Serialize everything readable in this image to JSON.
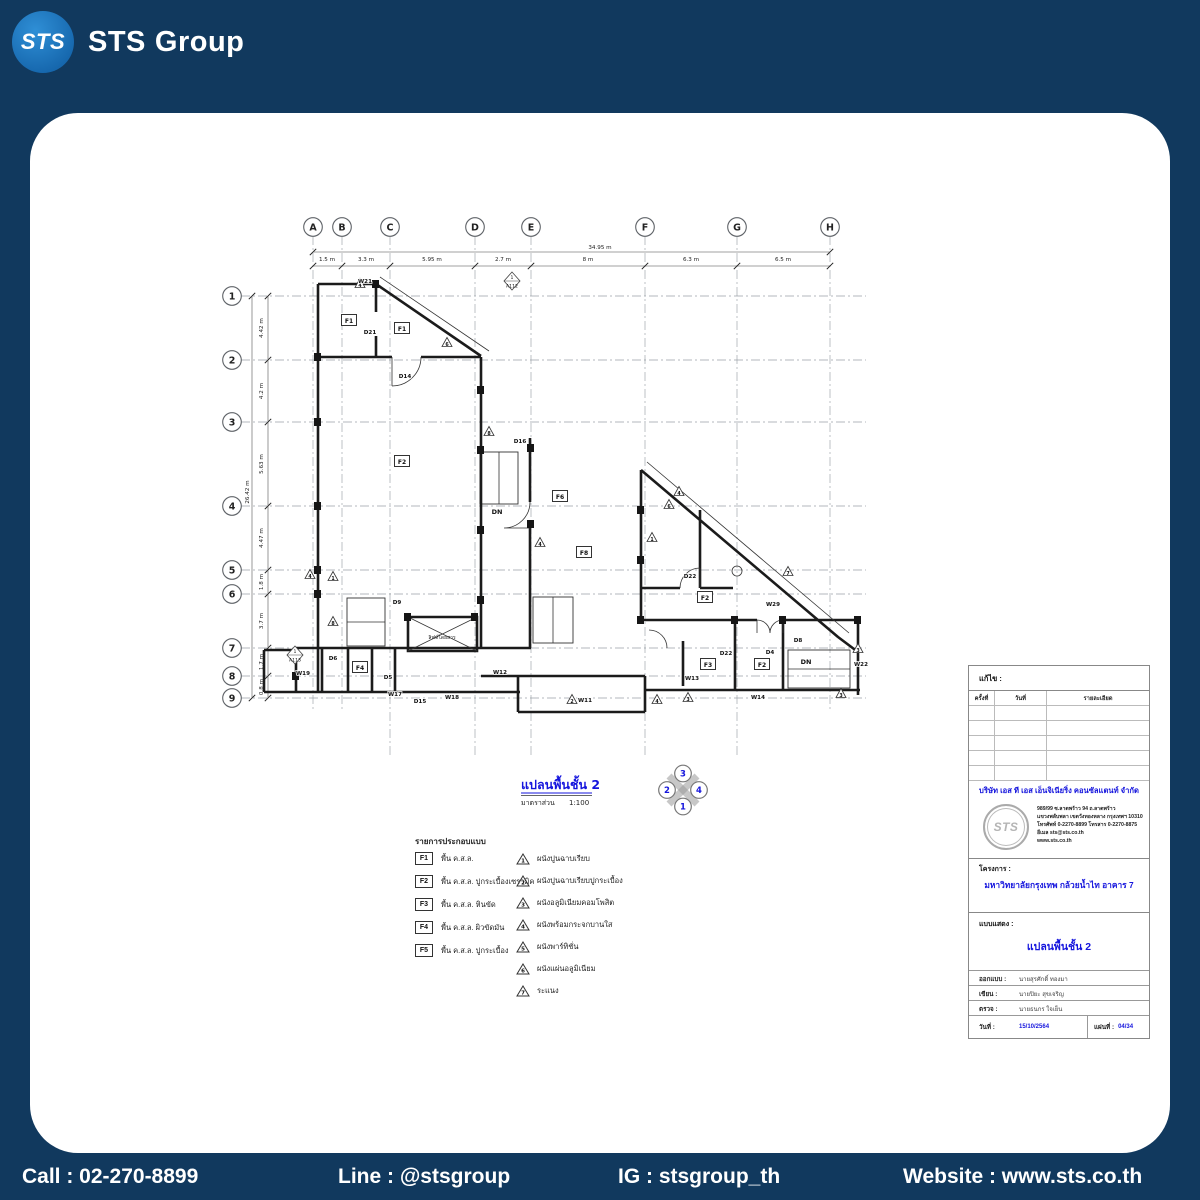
{
  "brand": {
    "circle_text": "STS",
    "word1": "STS",
    "word2": "Group"
  },
  "footer": {
    "items": [
      "Call : 02-270-8899",
      "Line : @stsgroup",
      "IG : stsgroup_th",
      "Website : www.sts.co.th"
    ]
  },
  "colors": {
    "background": "#11395e",
    "card": "#ffffff",
    "accent_blue": "#1515dd",
    "logo_blue": "#1e78c8"
  },
  "plan": {
    "title": "แปลนพื้นชั้น 2",
    "scale_label": "มาตราส่วน",
    "scale_value": "1:100",
    "north": {
      "top": "3",
      "left": "2",
      "right": "4",
      "bottom": "1"
    },
    "grid_columns": [
      {
        "label": "A",
        "x": 313
      },
      {
        "label": "B",
        "x": 342
      },
      {
        "label": "C",
        "x": 390
      },
      {
        "label": "D",
        "x": 475
      },
      {
        "label": "E",
        "x": 531
      },
      {
        "label": "F",
        "x": 645
      },
      {
        "label": "G",
        "x": 737
      },
      {
        "label": "H",
        "x": 830
      }
    ],
    "grid_rows": [
      {
        "label": "1",
        "y": 296
      },
      {
        "label": "2",
        "y": 360
      },
      {
        "label": "3",
        "y": 422
      },
      {
        "label": "4",
        "y": 506
      },
      {
        "label": "5",
        "y": 570
      },
      {
        "label": "6",
        "y": 594
      },
      {
        "label": "7",
        "y": 648
      },
      {
        "label": "8",
        "y": 676
      },
      {
        "label": "9",
        "y": 698
      }
    ],
    "dim_top": {
      "total": "34.95 m",
      "segments": [
        {
          "label": "1.5 m",
          "x": 327
        },
        {
          "label": "3.3 m",
          "x": 366
        },
        {
          "label": "5.95 m",
          "x": 432
        },
        {
          "label": "2.7 m",
          "x": 503
        },
        {
          "label": "8 m",
          "x": 588
        },
        {
          "label": "6.3 m",
          "x": 691
        },
        {
          "label": "6.5 m",
          "x": 783
        }
      ]
    },
    "dim_left": {
      "total": "26.42 m",
      "segments": [
        {
          "label": "4.42 m",
          "y": 328
        },
        {
          "label": "4.2 m",
          "y": 391
        },
        {
          "label": "5.63 m",
          "y": 464
        },
        {
          "label": "4.47 m",
          "y": 538
        },
        {
          "label": "1.8 m",
          "y": 582
        },
        {
          "label": "3.7 m",
          "y": 621
        },
        {
          "label": "1.7 m",
          "y": 662
        },
        {
          "label": "0.8 m",
          "y": 687
        }
      ]
    },
    "diamonds": [
      {
        "top": "1",
        "bottom": "A112",
        "x": 512,
        "y": 281
      },
      {
        "top": "1",
        "bottom": "A113",
        "x": 295,
        "y": 655
      }
    ],
    "triangles": [
      {
        "n": "4",
        "x": 360,
        "y": 284
      },
      {
        "n": "6",
        "x": 447,
        "y": 343
      },
      {
        "n": "1",
        "x": 333,
        "y": 577
      },
      {
        "n": "4",
        "x": 310,
        "y": 575
      },
      {
        "n": "8",
        "x": 489,
        "y": 432
      },
      {
        "n": "4",
        "x": 540,
        "y": 543
      },
      {
        "n": "1",
        "x": 652,
        "y": 538
      },
      {
        "n": "6",
        "x": 669,
        "y": 505
      },
      {
        "n": "4",
        "x": 679,
        "y": 492
      },
      {
        "n": "7",
        "x": 788,
        "y": 572
      },
      {
        "n": "3",
        "x": 688,
        "y": 698
      },
      {
        "n": "3",
        "x": 841,
        "y": 694
      },
      {
        "n": "3",
        "x": 858,
        "y": 649
      },
      {
        "n": "8",
        "x": 333,
        "y": 622
      },
      {
        "n": "4",
        "x": 657,
        "y": 700
      },
      {
        "n": "2",
        "x": 572,
        "y": 700
      }
    ],
    "annotations": [
      {
        "t": "W21",
        "x": 365,
        "y": 281,
        "k": "tag"
      },
      {
        "t": "D21",
        "x": 370,
        "y": 332,
        "k": "tag"
      },
      {
        "t": "F1",
        "x": 349,
        "y": 321,
        "k": "box"
      },
      {
        "t": "F1",
        "x": 402,
        "y": 329,
        "k": "box"
      },
      {
        "t": "D14",
        "x": 405,
        "y": 376,
        "k": "tag"
      },
      {
        "t": "F2",
        "x": 402,
        "y": 462,
        "k": "box"
      },
      {
        "t": "D16",
        "x": 520,
        "y": 441,
        "k": "tag"
      },
      {
        "t": "DN",
        "x": 497,
        "y": 512,
        "k": "bold"
      },
      {
        "t": "F6",
        "x": 560,
        "y": 497,
        "k": "box"
      },
      {
        "t": "F8",
        "x": 584,
        "y": 553,
        "k": "box"
      },
      {
        "t": "D9",
        "x": 397,
        "y": 602,
        "k": "tag"
      },
      {
        "t": "D22",
        "x": 690,
        "y": 576,
        "k": "tag"
      },
      {
        "t": "F2",
        "x": 705,
        "y": 598,
        "k": "box"
      },
      {
        "t": "W29",
        "x": 773,
        "y": 604,
        "k": "tag"
      },
      {
        "t": "ลิฟท์โดยสาร",
        "x": 442,
        "y": 637,
        "k": "room"
      },
      {
        "t": "W19",
        "x": 303,
        "y": 673,
        "k": "tag"
      },
      {
        "t": "D6",
        "x": 333,
        "y": 658,
        "k": "tag"
      },
      {
        "t": "F4",
        "x": 360,
        "y": 668,
        "k": "box"
      },
      {
        "t": "D5",
        "x": 388,
        "y": 677,
        "k": "tag"
      },
      {
        "t": "W17",
        "x": 395,
        "y": 694,
        "k": "tag"
      },
      {
        "t": "D15",
        "x": 420,
        "y": 701,
        "k": "tag"
      },
      {
        "t": "W18",
        "x": 452,
        "y": 697,
        "k": "tag"
      },
      {
        "t": "W12",
        "x": 500,
        "y": 672,
        "k": "tag"
      },
      {
        "t": "W11",
        "x": 585,
        "y": 700,
        "k": "tag"
      },
      {
        "t": "W13",
        "x": 692,
        "y": 678,
        "k": "tag"
      },
      {
        "t": "D22",
        "x": 726,
        "y": 653,
        "k": "tag"
      },
      {
        "t": "F3",
        "x": 708,
        "y": 665,
        "k": "box"
      },
      {
        "t": "D4",
        "x": 770,
        "y": 652,
        "k": "tag"
      },
      {
        "t": "F2",
        "x": 762,
        "y": 665,
        "k": "box"
      },
      {
        "t": "D8",
        "x": 798,
        "y": 640,
        "k": "tag"
      },
      {
        "t": "DN",
        "x": 806,
        "y": 662,
        "k": "bold"
      },
      {
        "t": "W14",
        "x": 758,
        "y": 697,
        "k": "tag"
      },
      {
        "t": "W22",
        "x": 861,
        "y": 664,
        "k": "tag"
      }
    ]
  },
  "legend": {
    "title": "รายการประกอบแบบ",
    "floors": [
      {
        "code": "F1",
        "text": "พื้น ค.ส.ล."
      },
      {
        "code": "F2",
        "text": "พื้น ค.ส.ล. ปูกระเบื้องเซรามิค"
      },
      {
        "code": "F3",
        "text": "พื้น ค.ส.ล. หินขัด"
      },
      {
        "code": "F4",
        "text": "พื้น ค.ส.ล. ผิวขัดมัน"
      },
      {
        "code": "F5",
        "text": "พื้น ค.ส.ล. ปูกระเบื้อง"
      }
    ],
    "walls": [
      {
        "n": "1",
        "text": "ผนังปูนฉาบเรียบ"
      },
      {
        "n": "2",
        "text": "ผนังปูนฉาบเรียบปูกระเบื้อง"
      },
      {
        "n": "3",
        "text": "ผนังอลูมิเนียมคอมโพสิต"
      },
      {
        "n": "4",
        "text": "ผนังพร้อมกระจกบานใส"
      },
      {
        "n": "5",
        "text": "ผนังพาร์ทิชั่น"
      },
      {
        "n": "6",
        "text": "ผนังแผ่นอลูมิเนียม"
      },
      {
        "n": "7",
        "text": "ระแนง"
      }
    ]
  },
  "titleblock": {
    "revision_label": "แก้ไข :",
    "table_headers": [
      "ครั้งที่",
      "วันที่",
      "รายละเอียด"
    ],
    "company": "บริษัท เอส ที เอส เอ็นจิเนียริ่ง คอนซัลแตนท์ จำกัด",
    "logo_text": "STS",
    "address_lines": [
      "989/99 ซ.ลาดพร้าว 94 ถ.ลาดพร้าว",
      "แขวงพลับพลา เขตวังทองหลาง กรุงเทพฯ 10310",
      "โทรศัพท์ 0-2270-8899 โทรสาร 0-2270-8875",
      "อีเมล sts@sts.co.th",
      "www.sts.co.th"
    ],
    "project_label": "โครงการ :",
    "project_name": "มหาวิทยาลัยกรุงเทพ กล้วยน้ำไท อาคาร 7",
    "drawing_label": "แบบแสดง :",
    "drawing_name": "แปลนพื้นชั้น 2",
    "rows": [
      {
        "label": "ออกแบบ :",
        "value": "นายสุรศักดิ์ ทองมา"
      },
      {
        "label": "เขียน :",
        "value": "นายปิยะ สุขเจริญ"
      },
      {
        "label": "ตรวจ :",
        "value": "นายธนกร ใจเย็น"
      }
    ],
    "date_label": "วันที่ :",
    "date_value": "15/10/2564",
    "sheet_label": "แผ่นที่ :",
    "sheet_value": "04/34"
  }
}
